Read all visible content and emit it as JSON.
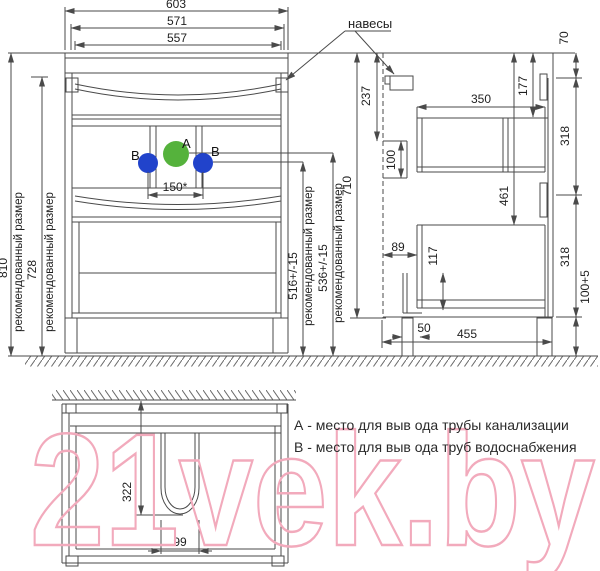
{
  "watermark": {
    "text": "21vek.by",
    "color": "#f2aabc"
  },
  "legend": {
    "item_a": "А - место для выв ода трубы канализации",
    "item_b": "В - место для выв ода труб водоснабжения"
  },
  "callouts": {
    "hangers": "навесы",
    "point_a": "A",
    "point_b": "B"
  },
  "notes": {
    "recommended": "рекомендованный размер"
  },
  "colors": {
    "line": "#4a4a4a",
    "point_a_fill": "#55b23c",
    "point_b_fill": "#2143cb",
    "watermark_stroke": "#f2aabc"
  },
  "dims": {
    "front": {
      "w603": "603",
      "w571": "571",
      "w557": "557",
      "h810": "810",
      "h728": "728",
      "pipes150": "150*",
      "h516": "516+/-15",
      "h536": "536+/-15",
      "h710": "710"
    },
    "side": {
      "v70": "70",
      "v237": "237",
      "v100": "100",
      "d350": "350",
      "v177": "177",
      "v461": "461",
      "v318": "318",
      "h89": "89",
      "v117": "117",
      "h50": "50",
      "d455": "455",
      "v100_5": "100+5"
    },
    "top": {
      "v322": "322",
      "w99": "99"
    }
  }
}
